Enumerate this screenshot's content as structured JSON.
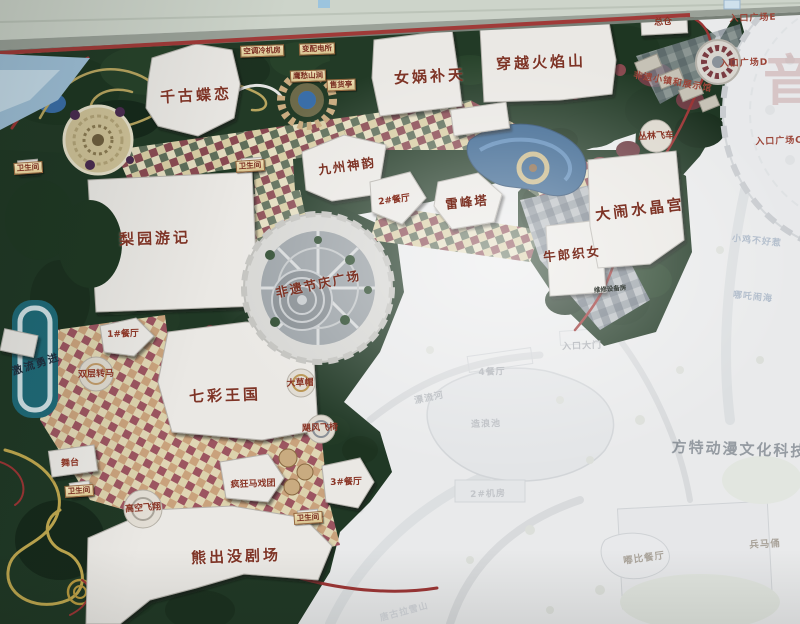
{
  "map": {
    "colors": {
      "label_red": "#7e3426",
      "frame_red": "#a03a38",
      "vivid_green": "#223a26",
      "water_blue": "#39648f",
      "faded_bg": "#e9eaeb",
      "wall_band": "#cdd4ca"
    },
    "labels": [
      {
        "id": "qiangudielian",
        "text": "千古蝶恋",
        "x": 196,
        "y": 95,
        "r": -3,
        "t": "attr-lg"
      },
      {
        "id": "nvwabutian",
        "text": "女娲补天",
        "x": 430,
        "y": 76,
        "r": -3,
        "t": "attr-lg"
      },
      {
        "id": "chuanyuehuoyanshan",
        "text": "穿越火焰山",
        "x": 541,
        "y": 62,
        "r": -2,
        "t": "attr-lg"
      },
      {
        "id": "liyuanyouji",
        "text": "梨园游记",
        "x": 155,
        "y": 238,
        "r": -2,
        "t": "attr-lg"
      },
      {
        "id": "qicaiwangguo",
        "text": "七彩王国",
        "x": 225,
        "y": 395,
        "r": -2,
        "t": "attr-lg"
      },
      {
        "id": "xiongchumojuchang",
        "text": "熊出没剧场",
        "x": 236,
        "y": 556,
        "r": -2,
        "t": "attr-lg"
      },
      {
        "id": "danaoshuijinggong",
        "text": "大闹水晶宫",
        "x": 640,
        "y": 209,
        "r": -7,
        "t": "attr-lg"
      },
      {
        "id": "jiuzhoushenyun",
        "text": "九州神韵",
        "x": 347,
        "y": 165,
        "r": -8,
        "t": "attr-md"
      },
      {
        "id": "feiyijieqingguangchang",
        "text": "非遗节庆广场",
        "x": 318,
        "y": 283,
        "r": -12,
        "t": "attr-md"
      },
      {
        "id": "leifengta",
        "text": "雷峰塔",
        "x": 467,
        "y": 201,
        "r": -6,
        "t": "attr-md"
      },
      {
        "id": "niulangzhinv",
        "text": "牛郎织女",
        "x": 572,
        "y": 253,
        "r": -6,
        "t": "attr-md"
      },
      {
        "id": "zongcang",
        "text": "总仓",
        "x": 663,
        "y": 21,
        "r": -3,
        "t": "attr-sm"
      },
      {
        "id": "canting2",
        "text": "2#餐厅",
        "x": 394,
        "y": 199,
        "r": -8,
        "t": "attr-sm"
      },
      {
        "id": "canting1",
        "text": "1#餐厅",
        "x": 123,
        "y": 333,
        "r": -2,
        "t": "attr-sm"
      },
      {
        "id": "canting3",
        "text": "3#餐厅",
        "x": 346,
        "y": 481,
        "r": -2,
        "t": "attr-sm"
      },
      {
        "id": "shuangcengzhuanma",
        "text": "双层转马",
        "x": 96,
        "y": 373,
        "r": -2,
        "t": "attr-sm"
      },
      {
        "id": "dacaomao",
        "text": "大草帽",
        "x": 300,
        "y": 382,
        "r": -2,
        "t": "attr-sm"
      },
      {
        "id": "jufengfeiyi",
        "text": "飓风飞椅",
        "x": 320,
        "y": 427,
        "r": -2,
        "t": "attr-sm"
      },
      {
        "id": "gaokongfeixiang",
        "text": "高空飞翔",
        "x": 143,
        "y": 507,
        "r": -4,
        "t": "attr-sm"
      },
      {
        "id": "fengkuangmaxituan",
        "text": "疯狂马戏团",
        "x": 253,
        "y": 483,
        "r": -2,
        "t": "attr-sm"
      },
      {
        "id": "wutai",
        "text": "舞台",
        "x": 70,
        "y": 462,
        "r": -4,
        "t": "attr-sm"
      },
      {
        "id": "conglinfeiche",
        "text": "丛林飞车",
        "x": 656,
        "y": 135,
        "r": -2,
        "t": "attr-sm"
      },
      {
        "id": "kongtiaolengjifang",
        "text": "空调冷机房",
        "x": 262,
        "y": 51,
        "r": -2,
        "t": "fac"
      },
      {
        "id": "bianpeidiansuo",
        "text": "变配电所",
        "x": 317,
        "y": 49,
        "r": -2,
        "t": "fac"
      },
      {
        "id": "yingchoushangjian",
        "text": "鹰愁山涧",
        "x": 308,
        "y": 76,
        "r": -2,
        "t": "fac"
      },
      {
        "id": "shouhuoting",
        "text": "售货亭",
        "x": 341,
        "y": 85,
        "r": -2,
        "t": "fac"
      },
      {
        "id": "weishengjian1",
        "text": "卫生间",
        "x": 28,
        "y": 168,
        "r": -4,
        "t": "fac"
      },
      {
        "id": "weishengjian2",
        "text": "卫生间",
        "x": 250,
        "y": 166,
        "r": -4,
        "t": "fac"
      },
      {
        "id": "weishengjian3",
        "text": "卫生间",
        "x": 79,
        "y": 491,
        "r": -4,
        "t": "fac"
      },
      {
        "id": "weishengjian4",
        "text": "卫生间",
        "x": 308,
        "y": 518,
        "r": -4,
        "t": "fac"
      },
      {
        "id": "weixiushebeifang",
        "text": "维修设备房",
        "x": 610,
        "y": 288,
        "r": -5,
        "t": "facd"
      },
      {
        "id": "rukouguangchangE",
        "text": "入口广场E",
        "x": 753,
        "y": 17,
        "r": -2,
        "t": "ent"
      },
      {
        "id": "rukouguangchangD",
        "text": "入口广场D",
        "x": 744,
        "y": 62,
        "r": -2,
        "t": "ent"
      },
      {
        "id": "rukouguangchangC",
        "text": "入口广场C",
        "x": 779,
        "y": 140,
        "r": -2,
        "t": "ent"
      },
      {
        "id": "feiyixiaozhen",
        "text": "非遗小镇和展示馆",
        "x": 673,
        "y": 81,
        "r": 10,
        "t": "ent"
      },
      {
        "id": "jiliuyongjin",
        "text": "激流勇进",
        "x": 36,
        "y": 364,
        "r": -18,
        "t": "dark"
      },
      {
        "id": "canting4",
        "text": "4餐厅",
        "x": 492,
        "y": 371,
        "r": -2,
        "t": "fnt"
      },
      {
        "id": "piaoliuhe",
        "text": "漂流河",
        "x": 429,
        "y": 397,
        "r": -12,
        "t": "fnt"
      },
      {
        "id": "zaolangchi",
        "text": "造浪池",
        "x": 486,
        "y": 423,
        "r": -2,
        "t": "fnt"
      },
      {
        "id": "jifang2",
        "text": "2#机房",
        "x": 488,
        "y": 493,
        "r": -2,
        "t": "fnt"
      },
      {
        "id": "rukoudamen",
        "text": "入口大门",
        "x": 582,
        "y": 345,
        "r": -2,
        "t": "fnt"
      },
      {
        "id": "tanggulaxueshan",
        "text": "唐古拉雪山",
        "x": 404,
        "y": 611,
        "r": -15,
        "t": "fnt"
      },
      {
        "id": "xiaojibuhaore",
        "text": "小鸡不好惹",
        "x": 757,
        "y": 240,
        "r": 6,
        "t": "fntb"
      },
      {
        "id": "nezhanaohai",
        "text": "哪吒闹海",
        "x": 753,
        "y": 296,
        "r": 6,
        "t": "fntb"
      },
      {
        "id": "dubicanting",
        "text": "嘟比餐厅",
        "x": 644,
        "y": 557,
        "r": -8,
        "t": "fntt"
      },
      {
        "id": "bingmayong",
        "text": "兵马俑",
        "x": 765,
        "y": 543,
        "r": -3,
        "t": "fntt"
      },
      {
        "id": "watermark-yin",
        "text": "音",
        "x": 790,
        "y": 76,
        "r": 0,
        "t": "wm1"
      },
      {
        "id": "watermark-fantawild",
        "text": "方特动漫文化科技园",
        "x": 748,
        "y": 449,
        "r": 2,
        "t": "wm2"
      }
    ]
  }
}
